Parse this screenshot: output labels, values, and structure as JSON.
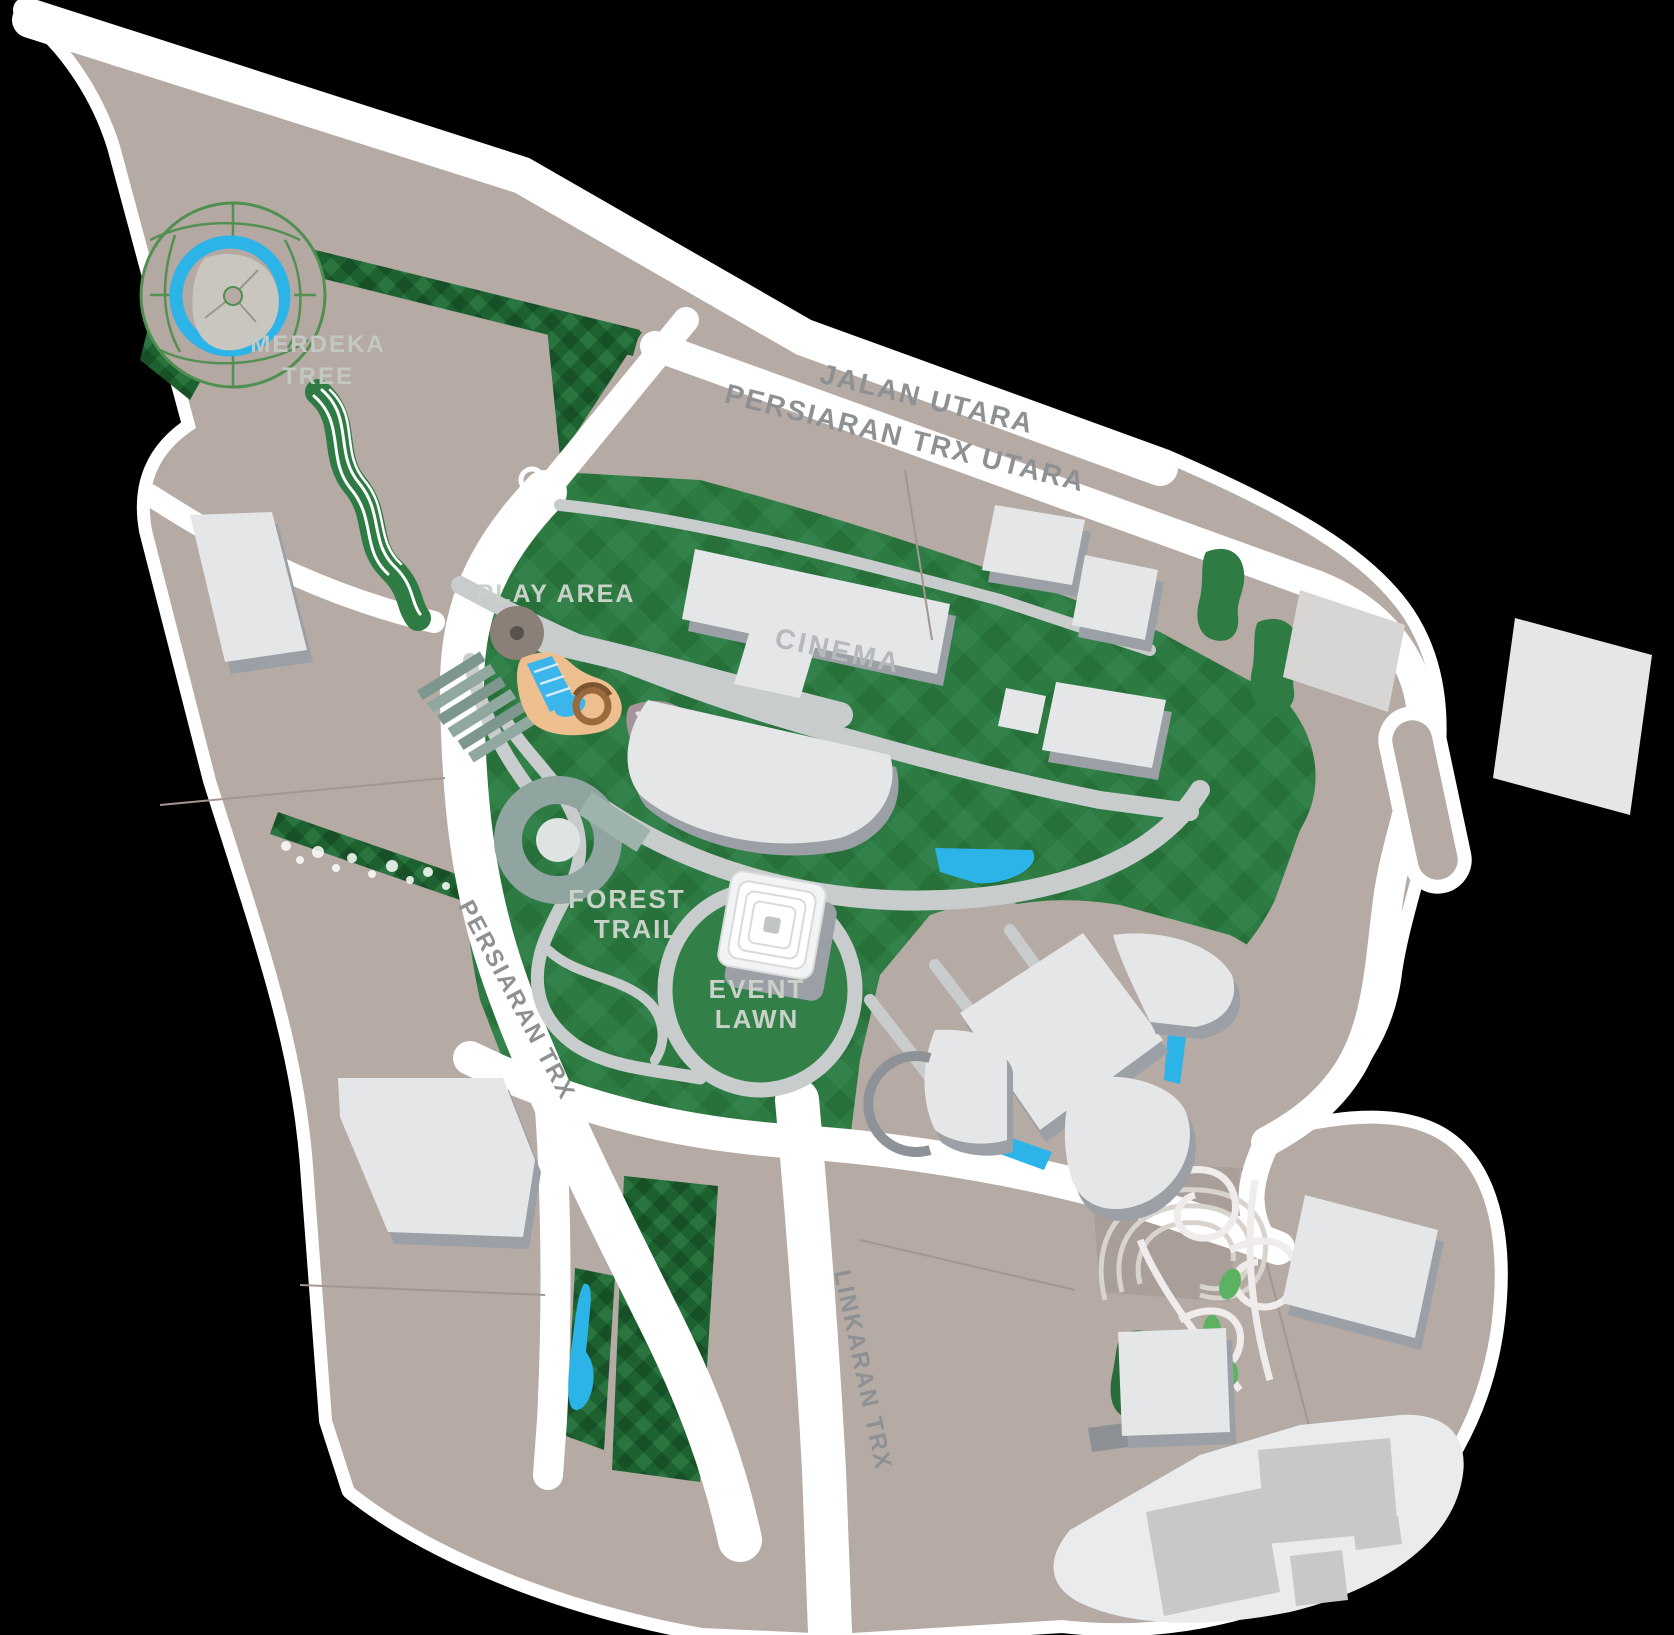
{
  "background_color": "#000000",
  "palette": {
    "land": "#b5aaa4",
    "land_dark": "#a99e98",
    "road_white": "#ffffff",
    "park_green": "#2d7a43",
    "park_green_dark": "#27703a",
    "park_green_light": "#33824b",
    "hedge_green": "#1d6130",
    "building_fill": "#e4e6e8",
    "building_shadow": "#9aa0a6",
    "path_gray": "#c9cccc",
    "water_blue": "#2cb3e8",
    "sand_tan": "#edbf8e",
    "terrace_teal": "#859c93",
    "stream_green": "#2e7b44",
    "road_label_gray": "#8d9194",
    "park_label_gray": "#c9d1c9"
  },
  "road_labels": {
    "jalan_utara": "JALAN UTARA",
    "persiaran_trx_utara": "PERSIARAN TRX UTARA",
    "persiaran_trx": "PERSIARAN TRX",
    "linkaran_trx": "LINKARAN TRX"
  },
  "place_labels": {
    "merdeka_tree": {
      "line1": "MERDEKA",
      "line2": "TREE"
    },
    "play_area": "PLAY AREA",
    "cinema": "CINEMA",
    "forest_trail": {
      "line1": "FOREST",
      "line2": "TRAIL"
    },
    "event_lawn": {
      "line1": "EVENT",
      "line2": "LAWN"
    }
  }
}
